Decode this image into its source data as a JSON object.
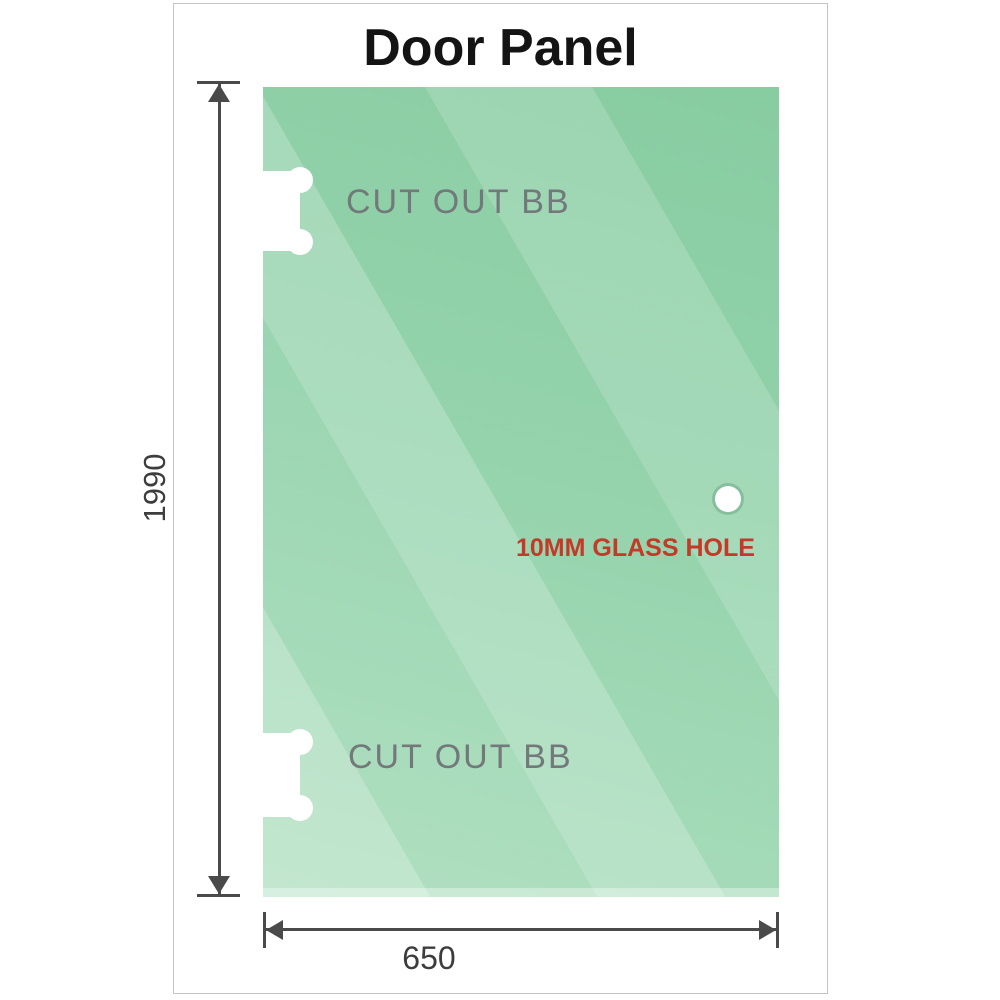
{
  "title": {
    "text": "Door Panel"
  },
  "panel": {
    "cutouts": [
      {
        "label": "CUT OUT BB"
      },
      {
        "label": "CUT OUT BB"
      }
    ],
    "hole": {
      "label": "10MM GLASS HOLE"
    }
  },
  "dimensions": {
    "height": "1990",
    "width": "650"
  },
  "colors": {
    "glass_base": "#8ccfa6",
    "glass_light": "#b9e5ca",
    "dimension_line": "#4a4a4a",
    "dimension_text": "#3d3d3d",
    "cutout_label": "#73797b",
    "hole_label": "#c43a28",
    "frame_border": "#c4c4c4",
    "title_text": "#141414"
  }
}
